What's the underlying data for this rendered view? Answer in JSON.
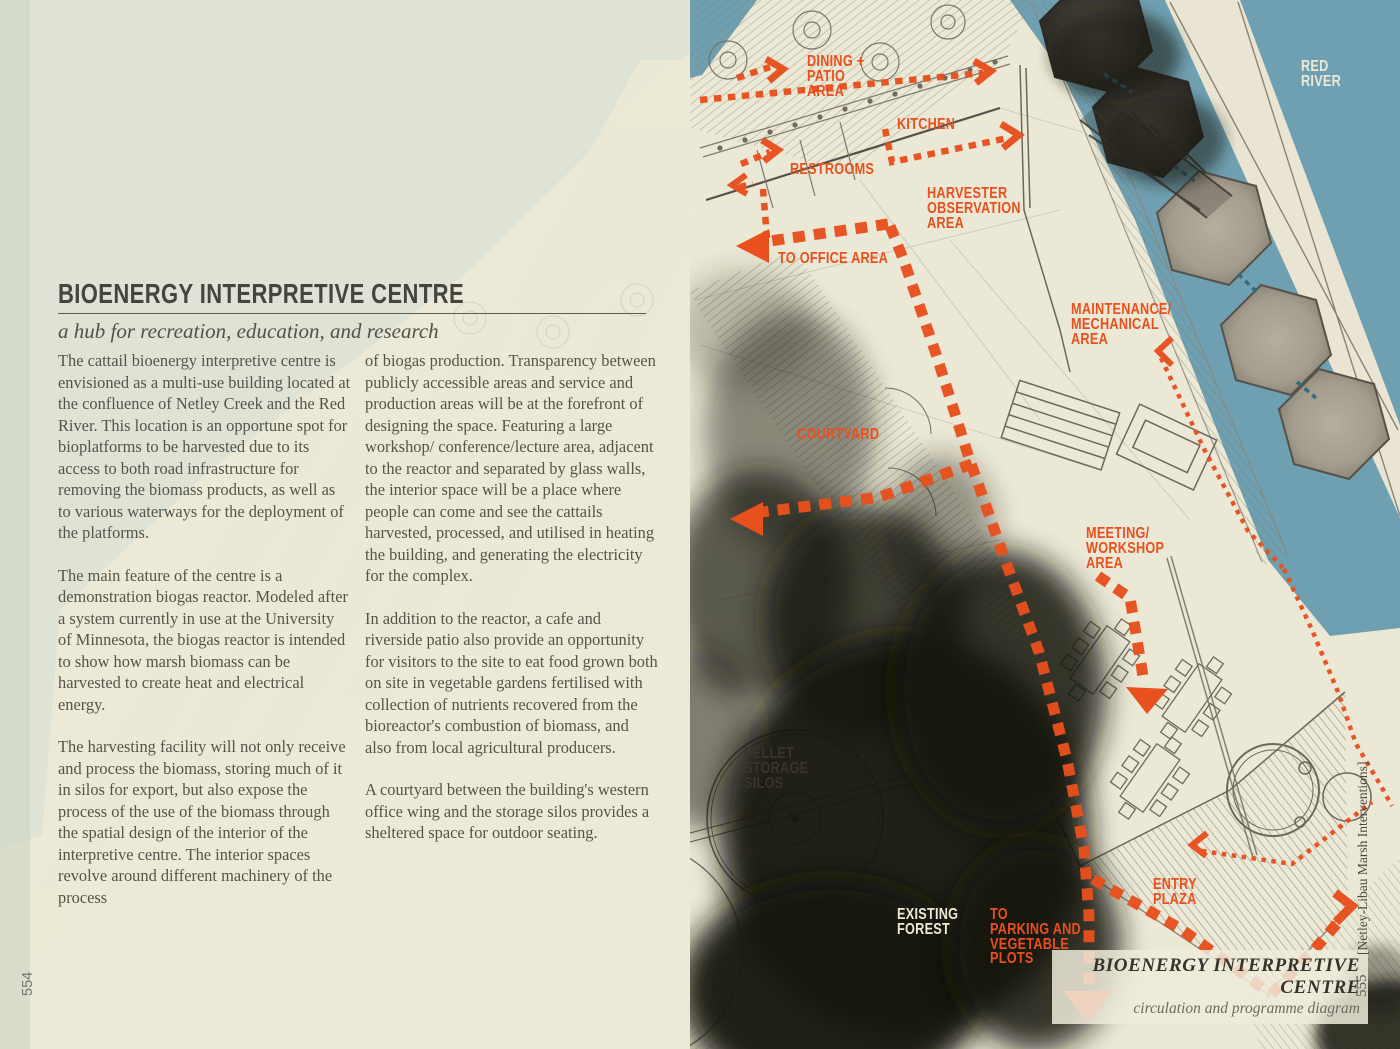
{
  "colors": {
    "accent_orange": "#e8501d",
    "river_blue": "#6fa0b1",
    "paper_cream": "#ece9d7",
    "sage_green": "#dee3d6",
    "ink_dark": "#3b3833",
    "body_text_gray": "#56534b",
    "teal_connector": "#2f6d7d"
  },
  "left_page": {
    "page_number": "554",
    "title": "BIOENERGY INTERPRETIVE CENTRE",
    "subtitle": "a hub for recreation, education, and research",
    "column1": [
      "The cattail bioenergy interpretive centre is envisioned as a multi-use building located at the confluence of Netley Creek and the Red River. This location is an opportune spot for bioplatforms to be harvested due to its access to both road infrastructure for removing the biomass products, as well as to various waterways for the deployment of the platforms.",
      "The main feature of the centre is a demonstration biogas reactor. Modeled after a system currently in use at the University of Minnesota, the biogas reactor is intended to show how marsh biomass can be harvested to create heat and electrical energy.",
      "The harvesting facility will not only receive and process the biomass, storing much of it in silos for export, but also expose the process of the use of the biomass through the spatial design of the interior of the interpretive centre. The interior spaces revolve around different machinery of the process"
    ],
    "column2": [
      "of biogas production. Transparency between publicly accessible areas and service and production areas will be at the forefront of designing the space. Featuring a large workshop/ conference/lecture area, adjacent to the reactor and separated by glass walls, the interior space will be a place where people can come and see the cattails harvested, processed, and utilised in heating the building, and generating the electricity for the complex.",
      "In addition to the reactor, a cafe and riverside patio also provide an opportunity for visitors to the site to eat food grown both on site in vegetable gardens fertilised with collection of nutrients recovered from the bioreactor's combustion of biomass, and also from local agricultural producers.",
      "A courtyard between the building's western office wing and the storage silos provides a sheltered space for outdoor seating."
    ]
  },
  "right_page": {
    "page_number": "555",
    "sidebar_text": "[Netley-Libau Marsh Interventions]",
    "caption": {
      "title": "BIOENERGY INTERPRETIVE CENTRE",
      "subtitle": "circulation and programme diagram"
    },
    "labels": {
      "dining": "DINING +\nPATIO\nAREA",
      "kitchen": "KITCHEN",
      "restrooms": "RESTROOMS",
      "harvester": "HARVESTER\nOBSERVATION\nAREA",
      "to_office": "TO OFFICE AREA",
      "maintenance": "MAINTENANCE/\nMECHANICAL\nAREA",
      "courtyard": "COURTYARD",
      "meeting": "MEETING/\nWORKSHOP\nAREA",
      "entry_plaza": "ENTRY\nPLAZA",
      "to_parking": "TO\nPARKING AND\nVEGETABLE\nPLOTS",
      "pellet_silos": "PELLET\nSTORAGE\nSILOS",
      "existing_forest": "EXISTING\nFOREST",
      "red_river": "RED\nRIVER"
    }
  }
}
